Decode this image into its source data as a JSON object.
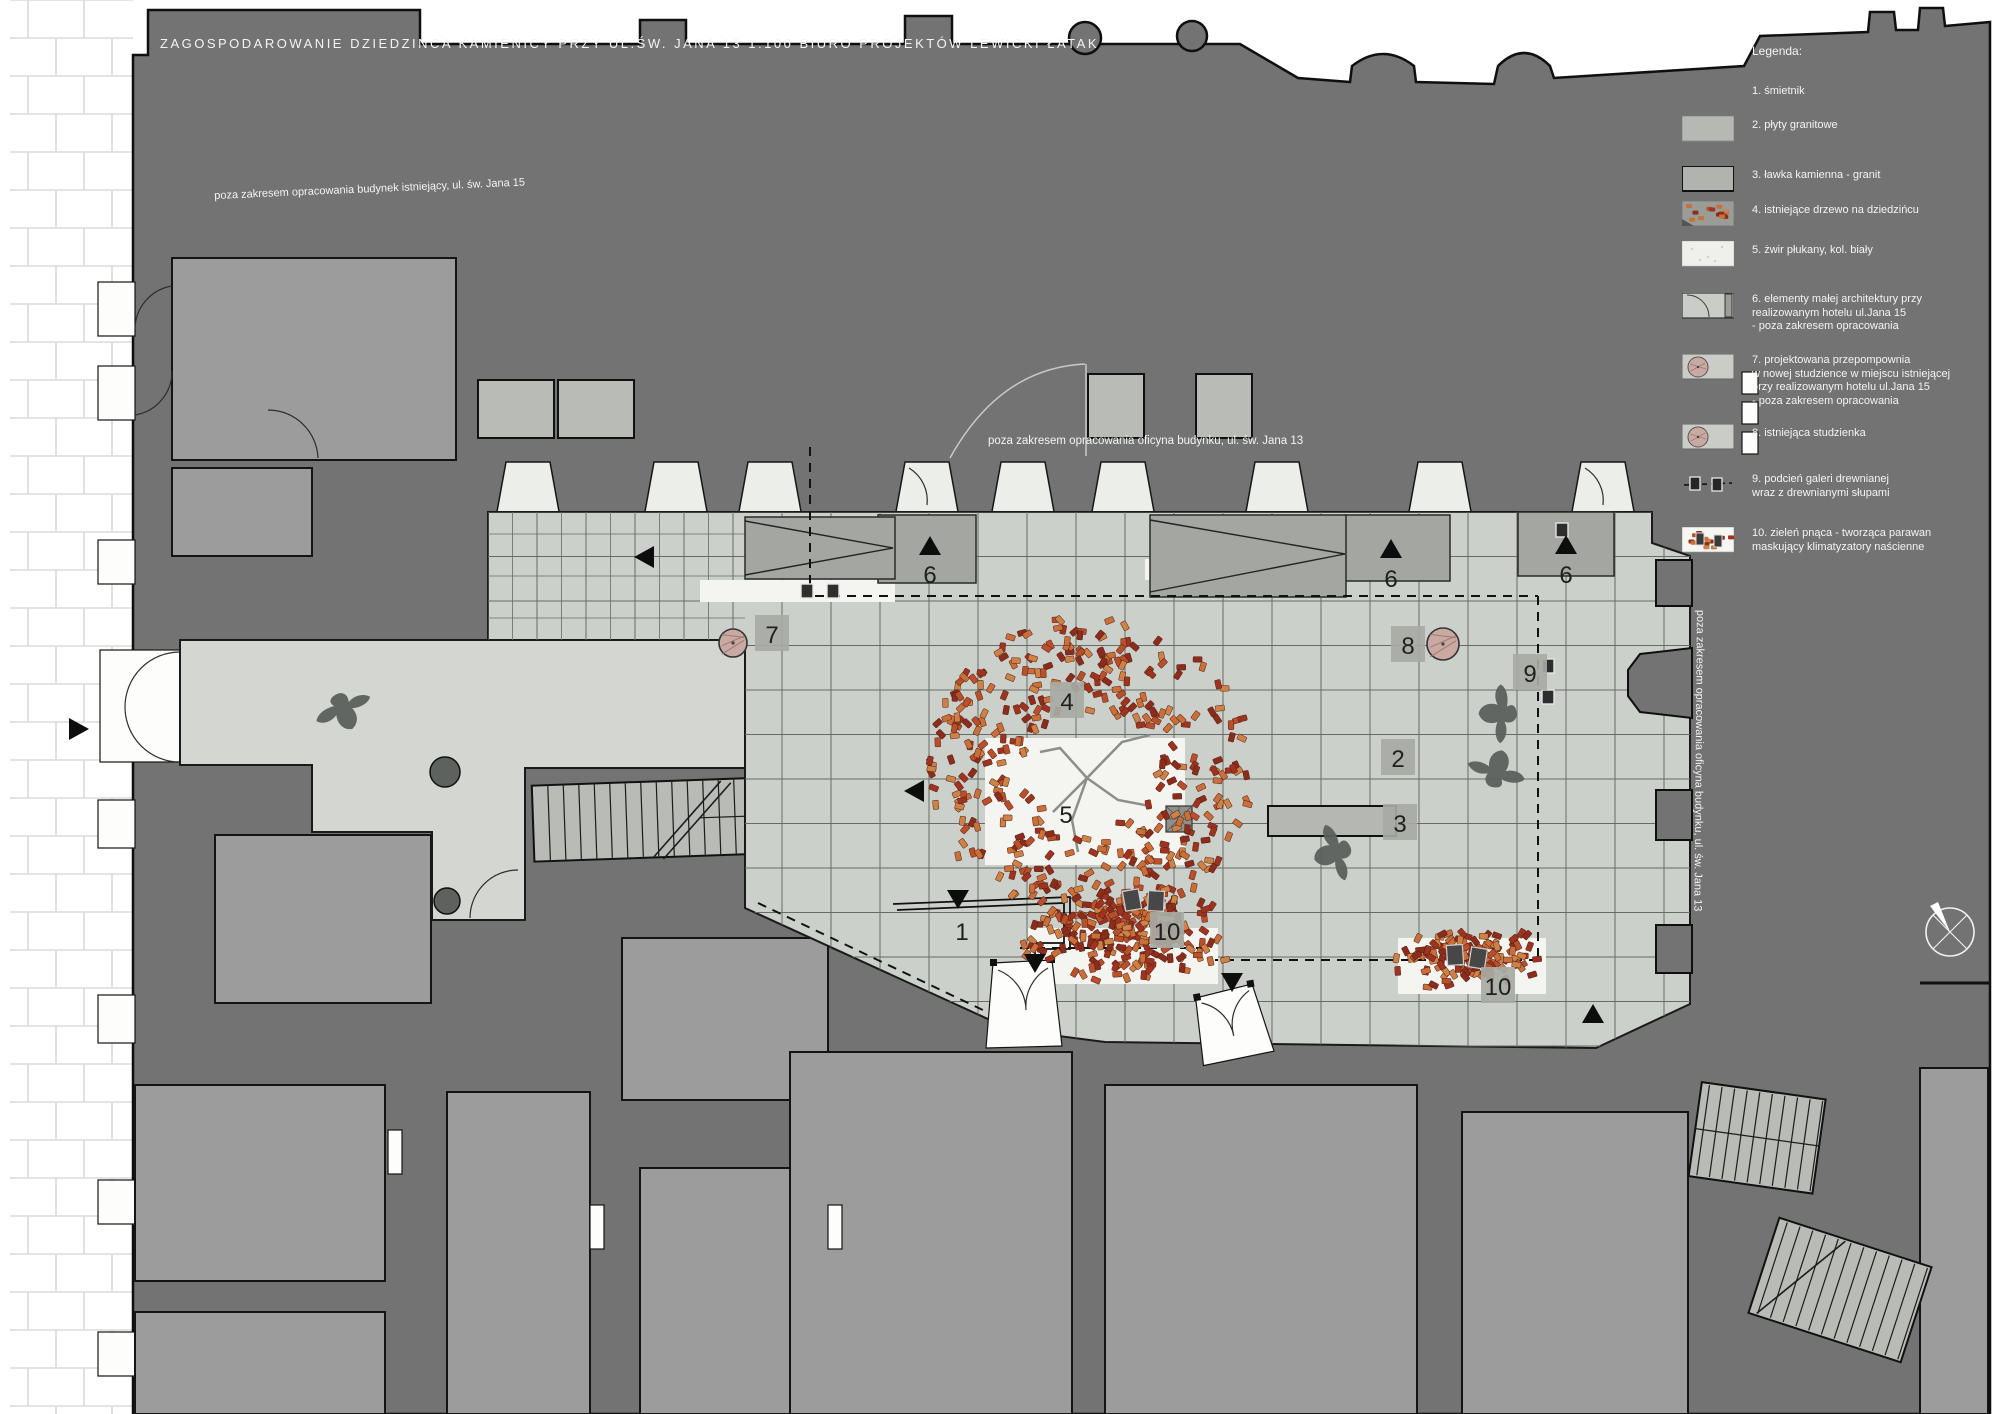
{
  "title": "ZAGOSPODAROWANIE DZIEDZIŃCA KAMIENICY PRZY UL.ŚW. JANA 13  1:100  BIURO PROJEKTÓW LEWICKI ŁATAK",
  "annotations": {
    "top_left": "poza zakresem opracowania budynek istniejący, ul. św. Jana 15",
    "center": "poza zakresem opracowania oficyna budynku, ul. św. Jana 13",
    "right_vertical": "poza zakresem opracowania oficyna budynku, ul. św. Jana 13"
  },
  "legend": {
    "heading": "Legenda:",
    "items": [
      {
        "num": "1.",
        "swatch": "none",
        "lines": [
          "śmietnik"
        ]
      },
      {
        "num": "2.",
        "swatch": "granite",
        "lines": [
          "płyty granitowe"
        ]
      },
      {
        "num": "3.",
        "swatch": "bench",
        "lines": [
          "ławka kamienna - granit"
        ]
      },
      {
        "num": "4.",
        "swatch": "tree",
        "lines": [
          "istniejące drzewo na dziedzińcu"
        ]
      },
      {
        "num": "5.",
        "swatch": "gravel",
        "lines": [
          "żwir płukany, kol. biały"
        ]
      },
      {
        "num": "6.",
        "swatch": "door",
        "lines": [
          "elementy małej architektury przy",
          "realizowanym hotelu ul.Jana 15",
          "- poza zakresem opracowania"
        ]
      },
      {
        "num": "7.",
        "swatch": "well",
        "lines": [
          "projektowana przepompownia",
          "w nowej studzience w miejscu istniejącej",
          "przy realizowanym hotelu ul.Jana 15",
          "- poza zakresem opracowania"
        ]
      },
      {
        "num": "8.",
        "swatch": "well",
        "lines": [
          "istniejąca studzienka"
        ]
      },
      {
        "num": "9.",
        "swatch": "posts",
        "lines": [
          "podcień galeri drewnianej",
          "wraz z drewnianymi słupami"
        ]
      },
      {
        "num": "10.",
        "swatch": "vine",
        "lines": [
          "zieleń pnąca - tworząca parawan",
          "maskujący klimatyzatory naścienne"
        ]
      }
    ]
  },
  "markers": [
    {
      "n": "1",
      "x": 962,
      "y": 931,
      "boxed": false
    },
    {
      "n": "2",
      "x": 1398,
      "y": 758,
      "boxed": true
    },
    {
      "n": "3",
      "x": 1400,
      "y": 823,
      "boxed": true
    },
    {
      "n": "4",
      "x": 1067,
      "y": 701,
      "boxed": true
    },
    {
      "n": "5",
      "x": 1066,
      "y": 814,
      "boxed": false
    },
    {
      "n": "6",
      "x": 930,
      "y": 574,
      "boxed": false
    },
    {
      "n": "6",
      "x": 1391,
      "y": 578,
      "boxed": false
    },
    {
      "n": "6",
      "x": 1566,
      "y": 574,
      "boxed": false
    },
    {
      "n": "7",
      "x": 772,
      "y": 634,
      "boxed": true
    },
    {
      "n": "8",
      "x": 1408,
      "y": 645,
      "boxed": true
    },
    {
      "n": "9",
      "x": 1530,
      "y": 673,
      "boxed": true
    },
    {
      "n": "10",
      "x": 1167,
      "y": 931,
      "boxed": true
    },
    {
      "n": "10",
      "x": 1498,
      "y": 986,
      "boxed": true
    }
  ],
  "arrows": [
    {
      "x": 930,
      "y": 546,
      "dir": "up"
    },
    {
      "x": 1391,
      "y": 549,
      "dir": "up"
    },
    {
      "x": 1566,
      "y": 545,
      "dir": "up"
    },
    {
      "x": 1593,
      "y": 1014,
      "dir": "up"
    },
    {
      "x": 645,
      "y": 557,
      "dir": "left"
    },
    {
      "x": 915,
      "y": 791,
      "dir": "left"
    },
    {
      "x": 78,
      "y": 729,
      "dir": "right"
    },
    {
      "x": 958,
      "y": 899,
      "dir": "down"
    },
    {
      "x": 1035,
      "y": 963,
      "dir": "down"
    },
    {
      "x": 1232,
      "y": 982,
      "dir": "down"
    }
  ],
  "wells": [
    {
      "x": 733,
      "y": 643,
      "r": 14,
      "kind": "proposed"
    },
    {
      "x": 1443,
      "y": 644,
      "r": 16,
      "kind": "existing"
    },
    {
      "x": 445,
      "y": 772,
      "r": 15,
      "kind": "manhole"
    },
    {
      "x": 447,
      "y": 901,
      "r": 13,
      "kind": "manhole"
    }
  ],
  "posts": [
    [
      807,
      591
    ],
    [
      833,
      591
    ],
    [
      1548,
      666
    ],
    [
      1548,
      697
    ],
    [
      1562,
      530
    ]
  ],
  "ac_units": [
    [
      1132,
      900
    ],
    [
      1156,
      901
    ],
    [
      1455,
      955
    ],
    [
      1478,
      958
    ]
  ],
  "trees": [
    {
      "type": "ring",
      "cx": 1090,
      "cy": 770,
      "r1": 62,
      "r2": 162,
      "n": 400
    },
    {
      "type": "band",
      "cx": 1128,
      "cy": 936,
      "w": 215,
      "h": 95,
      "n": 210
    },
    {
      "type": "band",
      "cx": 1470,
      "cy": 958,
      "w": 150,
      "h": 66,
      "n": 130
    }
  ],
  "figures": [
    {
      "x": 345,
      "y": 712,
      "rot": -20
    },
    {
      "x": 1497,
      "y": 714,
      "rot": 95
    },
    {
      "x": 1497,
      "y": 768,
      "rot": 200
    },
    {
      "x": 1332,
      "y": 854,
      "rot": 75
    }
  ],
  "compass": {
    "x": 1950,
    "y": 932,
    "r": 24
  },
  "colors": {
    "dark": "#737373",
    "medium": "#9c9c9c",
    "medium2": "#a3a6a1",
    "room_light": "#b8bbb6",
    "floor": "#d3d6d1",
    "tile": "#ccd0cb",
    "gravel": "#f4f4f1",
    "grid": "#666b66",
    "pink": "#c9a9a1",
    "marker_box": "#a7aaa4",
    "text": "#f4f4f4",
    "line": "#141414",
    "leaves": [
      "#9e3420",
      "#b9502c",
      "#c96f3a",
      "#8a2d1c",
      "#cd8347"
    ]
  }
}
